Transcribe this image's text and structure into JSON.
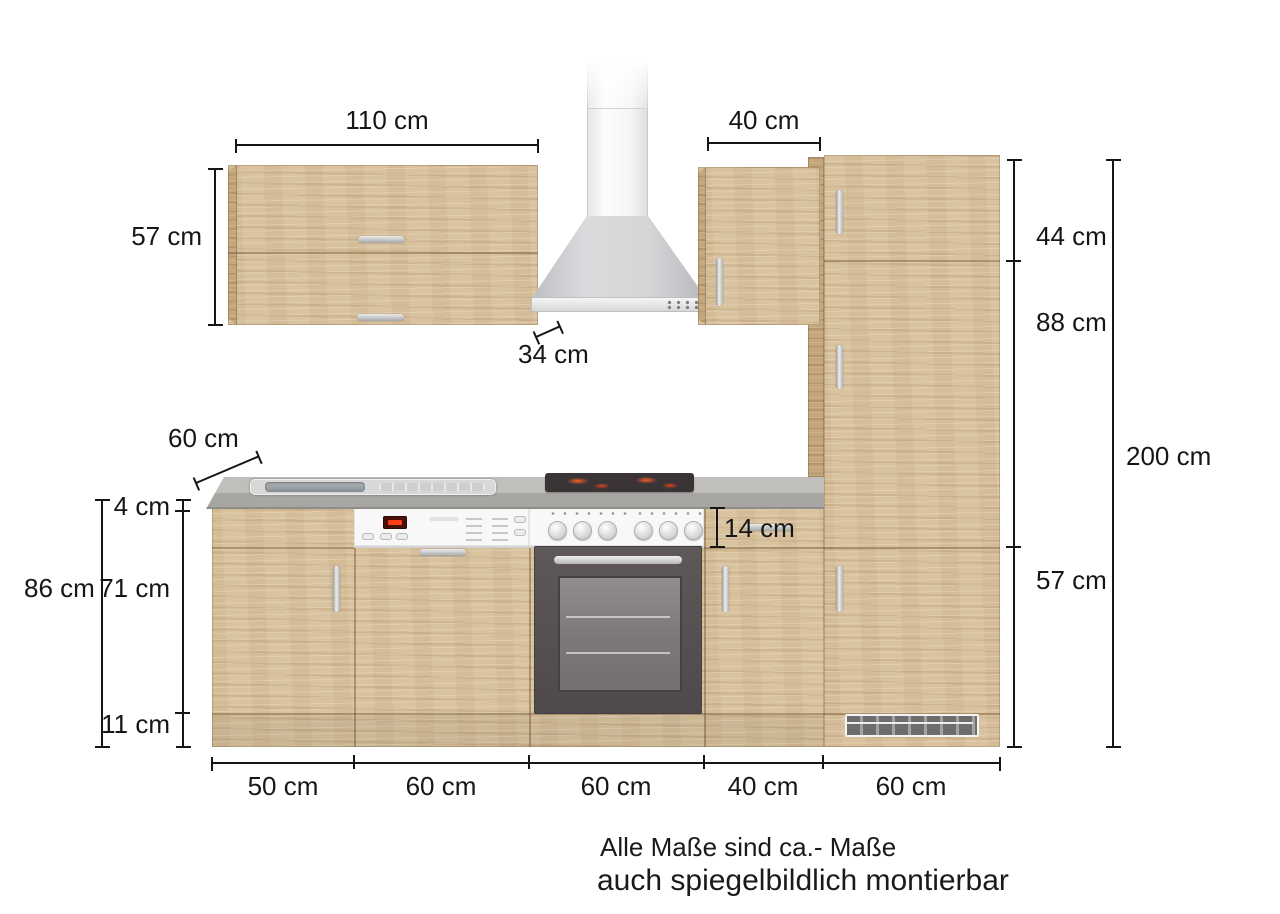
{
  "dimensions": {
    "wall_cabinet_width": "110 cm",
    "hood_wall_cabinet_width": "40 cm",
    "wall_cabinet_height": "57 cm",
    "wall_cabinet_depth": "34 cm",
    "worktop_depth": "60 cm",
    "worktop_thickness": "4 cm",
    "base_front_height": "71 cm",
    "plinth_height": "11 cm",
    "base_total_height": "86 cm",
    "drawer_front_height": "14 cm",
    "tall_top_door_height": "44 cm",
    "tall_middle_door_height": "88 cm",
    "tall_bottom_door_height": "57 cm",
    "total_height": "200 cm",
    "base_widths": [
      "50 cm",
      "60 cm",
      "60 cm",
      "40 cm",
      "60 cm"
    ]
  },
  "notes": {
    "line1": "Alle Maße sind ca.- Maße",
    "line2": "auch spiegelbildlich montierbar"
  }
}
